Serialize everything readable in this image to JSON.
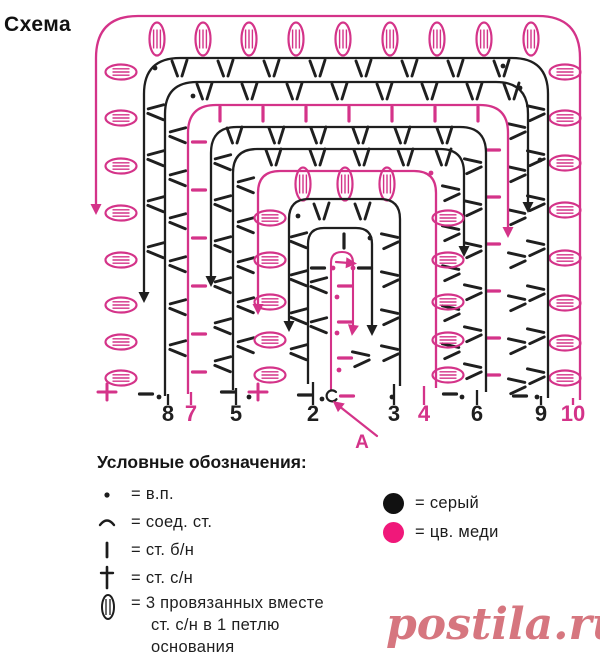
{
  "page": {
    "title": "Схема"
  },
  "colors": {
    "gray": "#1f1f1f",
    "copper": "#d43389",
    "copper_bright": "#f0187a",
    "watermark": "#d6767f"
  },
  "diagram": {
    "rounds": [
      {
        "label": "10",
        "color": "copper",
        "l": 96,
        "t": 16,
        "r": 580,
        "b": 400,
        "rad": 42,
        "start_x": 573,
        "dir": "ccw",
        "end_y": 205,
        "top": {
          "type": "oval-v",
          "y": 39,
          "xs": [
            157,
            203,
            249,
            296,
            343,
            390,
            437,
            484,
            531
          ]
        },
        "left": {
          "type": "oval-h",
          "x": 121,
          "ys": [
            72,
            118,
            166,
            213,
            260,
            305,
            342,
            378
          ]
        },
        "right": {
          "type": "oval-h",
          "x": 565,
          "ys": [
            72,
            118,
            163,
            210,
            258,
            303,
            343,
            378
          ]
        }
      },
      {
        "label": "9",
        "color": "gray",
        "l": 144,
        "t": 58,
        "r": 548,
        "b": 398,
        "rad": 36,
        "start_x": 541,
        "dir": "ccw",
        "end_y": 293,
        "top": {
          "type": "vee",
          "y": 69,
          "xs": [
            180,
            226,
            272,
            318,
            364,
            410,
            456,
            502
          ]
        },
        "left": {
          "type": "vee-l",
          "x": 155,
          "ys": [
            112,
            158,
            204,
            250
          ]
        },
        "right": {
          "type": "vee-r",
          "x": 537,
          "ys": [
            112,
            157,
            202,
            247,
            292,
            335,
            375
          ]
        }
      },
      {
        "label": "8",
        "color": "gray",
        "l": 165,
        "t": 82,
        "r": 528,
        "b": 396,
        "rad": 32,
        "start_x": 168,
        "dir": "cw",
        "end_y": 203,
        "top": {
          "type": "vee",
          "y": 92,
          "xs": [
            205,
            250,
            295,
            340,
            385,
            430,
            475,
            512
          ]
        },
        "left": {
          "type": "vee-l",
          "x": 177,
          "ys": [
            135,
            178,
            221,
            264,
            307,
            348
          ]
        },
        "right": {
          "type": "vee-r",
          "x": 518,
          "ys": [
            130,
            173,
            216,
            259,
            302,
            345,
            385
          ]
        }
      },
      {
        "label": "7",
        "color": "copper",
        "l": 188,
        "t": 105,
        "r": 508,
        "b": 394,
        "rad": 28,
        "start_x": 191,
        "dir": "cw",
        "end_y": 228,
        "top": {
          "type": "bar",
          "y": 114,
          "xs": [
            220,
            263,
            306,
            349,
            392,
            435,
            478
          ]
        },
        "left": {
          "type": "dash",
          "x": 199,
          "ys": [
            142,
            190,
            238,
            286,
            334,
            372
          ]
        },
        "right": {
          "type": "dash",
          "x": 493,
          "ys": [
            150,
            197,
            244,
            291,
            338,
            375
          ]
        }
      },
      {
        "label": "6",
        "color": "gray",
        "l": 211,
        "t": 127,
        "r": 486,
        "b": 392,
        "rad": 26,
        "start_x": 477,
        "dir": "ccw",
        "end_y": 277,
        "top": {
          "type": "vee",
          "y": 136,
          "xs": [
            235,
            277,
            319,
            361,
            403,
            445
          ]
        },
        "left": {
          "type": "vee-l",
          "x": 222,
          "ys": [
            162,
            203,
            244,
            285,
            326,
            364
          ]
        },
        "right": {
          "type": "vee-r",
          "x": 474,
          "ys": [
            165,
            207,
            249,
            291,
            333,
            370
          ]
        }
      },
      {
        "label": "5",
        "color": "gray",
        "l": 233,
        "t": 149,
        "r": 464,
        "b": 390,
        "rad": 24,
        "start_x": 236,
        "dir": "cw",
        "end_y": 247,
        "top": {
          "type": "vee",
          "y": 158,
          "xs": [
            274,
            318,
            362,
            406,
            444
          ]
        },
        "left": {
          "type": "vee-l",
          "x": 245,
          "ys": [
            185,
            225,
            265,
            305,
            345
          ]
        },
        "right": {
          "type": "vee-r",
          "x": 452,
          "ys": [
            192,
            232,
            272,
            312,
            350
          ]
        }
      },
      {
        "label": "4",
        "color": "copper",
        "l": 258,
        "t": 171,
        "r": 436,
        "b": 388,
        "rad": 22,
        "start_x": 424,
        "dir": "ccw",
        "end_y": 305,
        "top": {
          "type": "oval-v",
          "y": 184,
          "xs": [
            303,
            345,
            387
          ]
        },
        "left": {
          "type": "oval-h",
          "x": 270,
          "ys": [
            218,
            260,
            302,
            340,
            375
          ]
        },
        "right": {
          "type": "oval-h",
          "x": 448,
          "ys": [
            218,
            260,
            302,
            340,
            375
          ]
        }
      },
      {
        "label": "3",
        "color": "gray",
        "l": 289,
        "t": 199,
        "r": 400,
        "b": 386,
        "rad": 20,
        "start_x": 394,
        "dir": "ccw",
        "end_y": 322,
        "top": {
          "type": "vee",
          "y": 212,
          "xs": [
            322,
            363
          ]
        },
        "left": {
          "type": "vee-l",
          "x": 298,
          "ys": [
            240,
            278,
            316,
            352
          ]
        },
        "right": {
          "type": "vee-r",
          "x": 391,
          "ys": [
            240,
            278,
            316,
            352
          ]
        }
      },
      {
        "label": "2",
        "color": "gray",
        "l": 308,
        "t": 228,
        "r": 372,
        "b": 384,
        "rad": 16,
        "start_x": 313,
        "dir": "cw",
        "end_y": 326,
        "top": {
          "type": "bar",
          "y": 241,
          "xs": [
            344
          ]
        },
        "left": {
          "type": "vee-l",
          "x": 318,
          "ys": [
            285,
            325
          ]
        },
        "right": {
          "type": "vee-r",
          "x": 362,
          "ys": [
            358
          ]
        }
      }
    ],
    "center": {
      "l": 331,
      "t": 252,
      "r": 353,
      "b": 390,
      "rad": 11,
      "end_y": 326,
      "dashes": {
        "x": 345,
        "ys": [
          286,
          322,
          358
        ]
      },
      "mini_arrow": {
        "x1": 336,
        "y1": 262,
        "x2": 349,
        "y2": 263
      }
    },
    "pink_dots": [
      [
        431,
        173
      ],
      [
        333,
        268
      ],
      [
        353,
        268
      ],
      [
        337,
        297
      ],
      [
        337,
        333
      ],
      [
        339,
        370
      ]
    ],
    "black_dots": [
      [
        155,
        68
      ],
      [
        503,
        66
      ],
      [
        520,
        88
      ],
      [
        193,
        96
      ],
      [
        540,
        160
      ],
      [
        298,
        216
      ],
      [
        370,
        238
      ],
      [
        159,
        397
      ],
      [
        249,
        397
      ],
      [
        322,
        399
      ],
      [
        392,
        397
      ],
      [
        462,
        397
      ],
      [
        537,
        397
      ]
    ],
    "black_dashes": [
      [
        318,
        268
      ],
      [
        365,
        268
      ],
      [
        146,
        394
      ],
      [
        228,
        392
      ],
      [
        305,
        395
      ],
      [
        450,
        394
      ],
      [
        520,
        396
      ]
    ],
    "pink_plus": [
      [
        107,
        392
      ],
      [
        258,
        392
      ]
    ],
    "pink_dashes": [
      [
        347,
        396
      ]
    ],
    "slip_stitch": {
      "x": 331,
      "y": 396
    },
    "numbers_y": 421,
    "numbers": [
      {
        "text": "8",
        "x": 168,
        "color": "gray"
      },
      {
        "text": "7",
        "x": 191,
        "color": "copper"
      },
      {
        "text": "5",
        "x": 236,
        "color": "gray"
      },
      {
        "text": "2",
        "x": 313,
        "color": "gray"
      },
      {
        "text": "3",
        "x": 394,
        "color": "gray"
      },
      {
        "text": "4",
        "x": 424,
        "color": "copper"
      },
      {
        "text": "6",
        "x": 477,
        "color": "gray"
      },
      {
        "text": "9",
        "x": 541,
        "color": "gray"
      },
      {
        "text": "10",
        "x": 573,
        "color": "copper"
      }
    ],
    "a_label": {
      "text": "А",
      "x": 362,
      "y": 448,
      "arrow": {
        "x1": 377,
        "y1": 436,
        "x2": 339,
        "y2": 406
      }
    }
  },
  "legend": {
    "header": "Условные обозначения:",
    "items": [
      {
        "symbol": "chain-dot",
        "label": "= в.п."
      },
      {
        "symbol": "slip-stitch-arc",
        "label": "= соед. ст."
      },
      {
        "symbol": "single-crochet-bar",
        "label": "= ст. б/н"
      },
      {
        "symbol": "double-crochet-cross",
        "label": "= ст. с/н"
      },
      {
        "symbol": "cluster-oval",
        "lines": [
          "= 3 провязанных вместе",
          "ст. с/н в 1 петлю",
          "основания"
        ]
      }
    ]
  },
  "color_key": [
    {
      "swatch": "#111111",
      "label": "= серый"
    },
    {
      "swatch": "#f0187a",
      "label": "= цв. меди"
    }
  ],
  "watermark": {
    "text": "postila.ru"
  }
}
